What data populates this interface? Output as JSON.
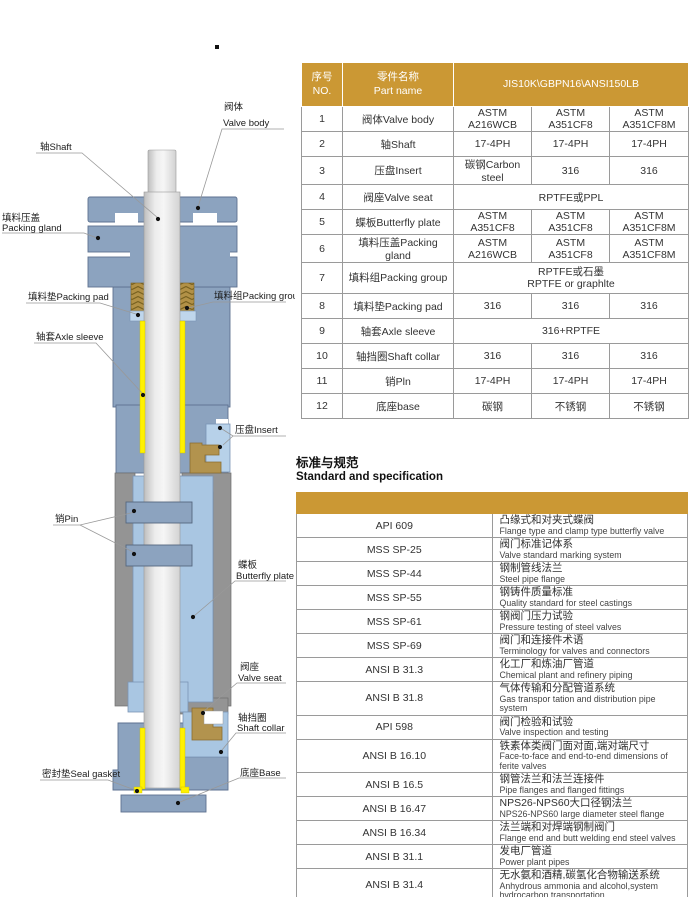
{
  "colors": {
    "accent_gold": "#CB9834",
    "body_blue": "#8CA3BF",
    "light_blue": "#A9C6E2",
    "wall_gray": "#949494",
    "highlight_yellow": "#FFF100",
    "packing_gold": "#B29147"
  },
  "diagram": {
    "labels": {
      "valve_body_zh": "阀体",
      "valve_body_en": "Valve body",
      "shaft": "轴Shaft",
      "packing_gland_zh": "填料压盖",
      "packing_gland_en": "Packing gland",
      "packing_pad": "填料垫Packing pad",
      "packing_group": "填料组Packing group",
      "axle_sleeve": "轴套Axle sleeve",
      "insert": "压盘Insert",
      "pin": "销Pin",
      "butterfly_plate_zh": "蝶板",
      "butterfly_plate_en": "Butterfly plate",
      "valve_seat_zh": "阀座",
      "valve_seat_en": "Valve seat",
      "shaft_collar_zh": "轴挡圈",
      "shaft_collar_en": "Shaft collar",
      "seal_gasket": "密封垫Seal gasket",
      "base": "底座Base"
    }
  },
  "parts": {
    "header": {
      "no_zh": "序号",
      "no_en": "NO.",
      "name_zh": "零件名称",
      "name_en": "Part name",
      "spec": "JIS10K\\GBPN16\\ANSI150LB"
    },
    "rows": [
      {
        "no": "1",
        "name": "阀体Valve body",
        "cells": [
          "ASTM A216WCB",
          "ASTM A351CF8",
          "ASTM A351CF8M"
        ]
      },
      {
        "no": "2",
        "name": "轴Shaft",
        "cells": [
          "17-4PH",
          "17-4PH",
          "17-4PH"
        ]
      },
      {
        "no": "3",
        "name": "压盘Insert",
        "cells": [
          "碳钢Carbon steel",
          "316",
          "316"
        ]
      },
      {
        "no": "4",
        "name": "阀座Valve seat",
        "span": "RPTFE或PPL"
      },
      {
        "no": "5",
        "name": "蝶板Butterfly plate",
        "cells": [
          "ASTM A351CF8",
          "ASTM A351CF8",
          "ASTM A351CF8M"
        ]
      },
      {
        "no": "6",
        "name": "填料压盖Packing gland",
        "cells": [
          "ASTM A216WCB",
          "ASTM A351CF8",
          "ASTM A351CF8M"
        ]
      },
      {
        "no": "7",
        "name": "填料组Packing group",
        "span_zh": "RPTFE或石墨",
        "span_en": "RPTFE or graphlte"
      },
      {
        "no": "8",
        "name": "填料垫Packing pad",
        "cells": [
          "316",
          "316",
          "316"
        ]
      },
      {
        "no": "9",
        "name": "轴套Axle sleeve",
        "span": "316+RPTFE"
      },
      {
        "no": "10",
        "name": "轴挡圈Shaft collar",
        "cells": [
          "316",
          "316",
          "316"
        ]
      },
      {
        "no": "11",
        "name": "销Pln",
        "cells": [
          "17-4PH",
          "17-4PH",
          "17-4PH"
        ]
      },
      {
        "no": "12",
        "name": "底座base",
        "cells": [
          "碳钢",
          "不锈钢",
          "不锈钢"
        ]
      }
    ]
  },
  "standards": {
    "title_zh": "标准与规范",
    "title_en": "Standard and specification",
    "rows": [
      {
        "code": "API 609",
        "zh": "凸缘式和对夹式蝶阀",
        "en": "Flange type and clamp type butterfly valve"
      },
      {
        "code": "MSS SP-25",
        "zh": "阀门标准记体系",
        "en": "Valve standard marking system"
      },
      {
        "code": "MSS SP-44",
        "zh": "钢制管线法兰",
        "en": "Steel pipe flange"
      },
      {
        "code": "MSS SP-55",
        "zh": "钢铸件质量标准",
        "en": "Quality standard for steel castings"
      },
      {
        "code": "MSS SP-61",
        "zh": "钢阀门压力试验",
        "en": "Pressure testing of steel valves"
      },
      {
        "code": "MSS SP-69",
        "zh": "阀门和连接件术语",
        "en": "Terminology for valves and connectors"
      },
      {
        "code": "ANSI B 31.3",
        "zh": "化工厂和炼油厂管道",
        "en": "Chemical plant and refinery piping"
      },
      {
        "code": "ANSI B 31.8",
        "zh": "气体传输和分配管道系统",
        "en": "Gas transpor tation and distribution pipe system"
      },
      {
        "code": "API 598",
        "zh": "阀门检验和试验",
        "en": "Valve inspection and testing"
      },
      {
        "code": "ANSI B 16.10",
        "zh": "铁素体类阀门面对面,端对端尺寸",
        "en": "Face-to-face and end-to-end dimensions of ferite valves"
      },
      {
        "code": "ANSI B 16.5",
        "zh": "钢管法兰和法兰连接件",
        "en": "Pipe flanges and flanged fittings"
      },
      {
        "code": "ANSI B 16.47",
        "zh": "NPS26-NPS60大口径钢法兰",
        "en": "NPS26-NPS60 large diameter steel flange"
      },
      {
        "code": "ANSI B 16.34",
        "zh": "法兰端和对焊端钢制阀门",
        "en": "Flange end and butt welding end steel valves"
      },
      {
        "code": "ANSI B 31.1",
        "zh": "发电厂管道",
        "en": "Power plant pipes"
      },
      {
        "code": "ANSI B 31.4",
        "zh": "无水氨和酒精,碳氢化合物输送系统",
        "en": "Anhydrous ammonia and alcohol,system hydrocarbon transportation"
      },
      {
        "code": "ANSI/FCI 70-2-1991",
        "zh": "控制阀门阀座泄漏",
        "en": "Control valve seat leakage"
      }
    ]
  }
}
